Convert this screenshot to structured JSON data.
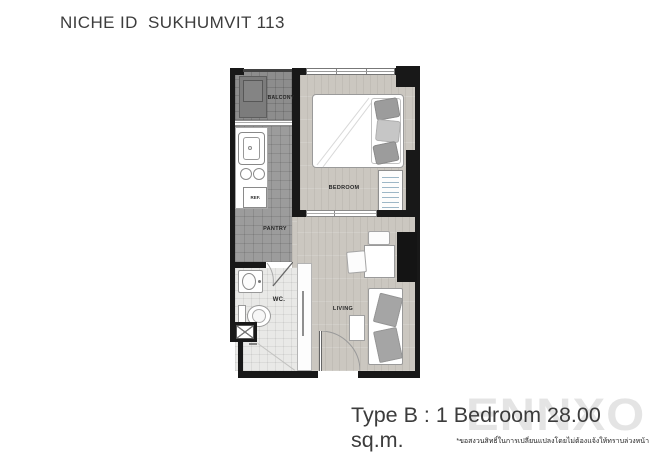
{
  "header": {
    "title": "NICHE ID  SUKHUMVIT 113"
  },
  "floorplan": {
    "rooms": {
      "balcony": "BALCONY",
      "pantry": "PANTRY",
      "wc": "WC.",
      "bedroom": "BEDROOM",
      "living": "LIVING"
    },
    "appliances": {
      "refrigerator": "REF."
    }
  },
  "footer": {
    "type_label": "Type B : 1 Bedroom 28.00 sq.m.",
    "disclaimer_th": "*ขอสงวนสิทธิ์ในการเปลี่ยนแปลงโดยไม่ต้องแจ้งให้ทราบล่วงหน้า",
    "watermark": "ENNXO"
  },
  "colors": {
    "wall": "#181818",
    "balcony_floor": "#8d8d8d",
    "pantry_floor": "#9c9c9c",
    "wc_floor": "#e9e9e7",
    "wood_floor": "#cbc7c0",
    "furniture_border": "#9a9a9a",
    "cushion_gray": "#a5a5a5",
    "title_text": "#3c3c3c",
    "watermark_gray": "#e4e4e4"
  }
}
